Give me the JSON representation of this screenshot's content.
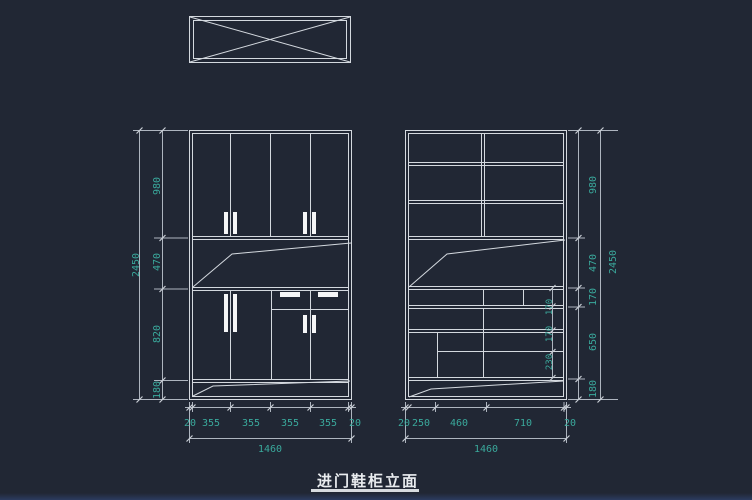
{
  "title": "进门鞋柜立面",
  "colors": {
    "background": "#212734",
    "cabinet_line": "#d4d9df",
    "dimension_line": "#aeb5bf",
    "dimension_text": "#3aa99c",
    "handle_fill": "#f5f6f7",
    "title_text": "#e9ecef"
  },
  "left_cabinet": {
    "total_height": "2450",
    "heights": [
      "980",
      "470",
      "820",
      "180"
    ],
    "widths": [
      "20",
      "355",
      "355",
      "355",
      "355",
      "20"
    ],
    "total_width": "1460"
  },
  "right_cabinet": {
    "total_height": "2450",
    "heights": [
      "980",
      "470",
      "170",
      "650",
      "180"
    ],
    "widths": [
      "20",
      "250",
      "460",
      "710",
      "20"
    ],
    "total_width": "1460",
    "interior_heights": [
      "170",
      "170",
      "230"
    ]
  }
}
